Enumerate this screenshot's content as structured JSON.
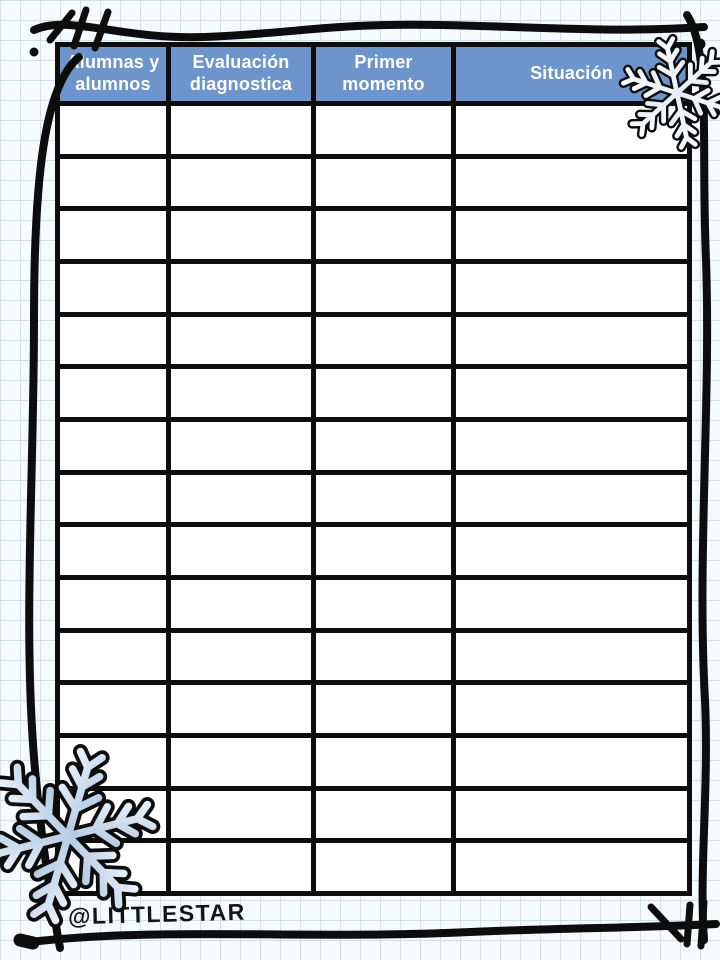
{
  "table": {
    "columns": [
      {
        "label": "Alumnas y alumnos"
      },
      {
        "label": "Evaluación diagnostica"
      },
      {
        "label": "Primer momento"
      },
      {
        "label": "Situación"
      }
    ],
    "empty_rows": 15
  },
  "footer": {
    "credit": "@LITTLESTAR"
  },
  "decorations": {
    "snowflakes": [
      "top-right",
      "bottom-left"
    ],
    "border_style": "hand-drawn-doodle-frame"
  },
  "colors": {
    "header_blue": "#6d95cc",
    "paper": "#f6fafc",
    "grid_line": "#cde1eb",
    "ink": "#0d0d0d",
    "snowflake_gradient_start": "#a3bedc",
    "snowflake_gradient_end": "#eff5fb",
    "snowflake_white_start": "#ffffff",
    "snowflake_white_end": "#dde8f3"
  }
}
